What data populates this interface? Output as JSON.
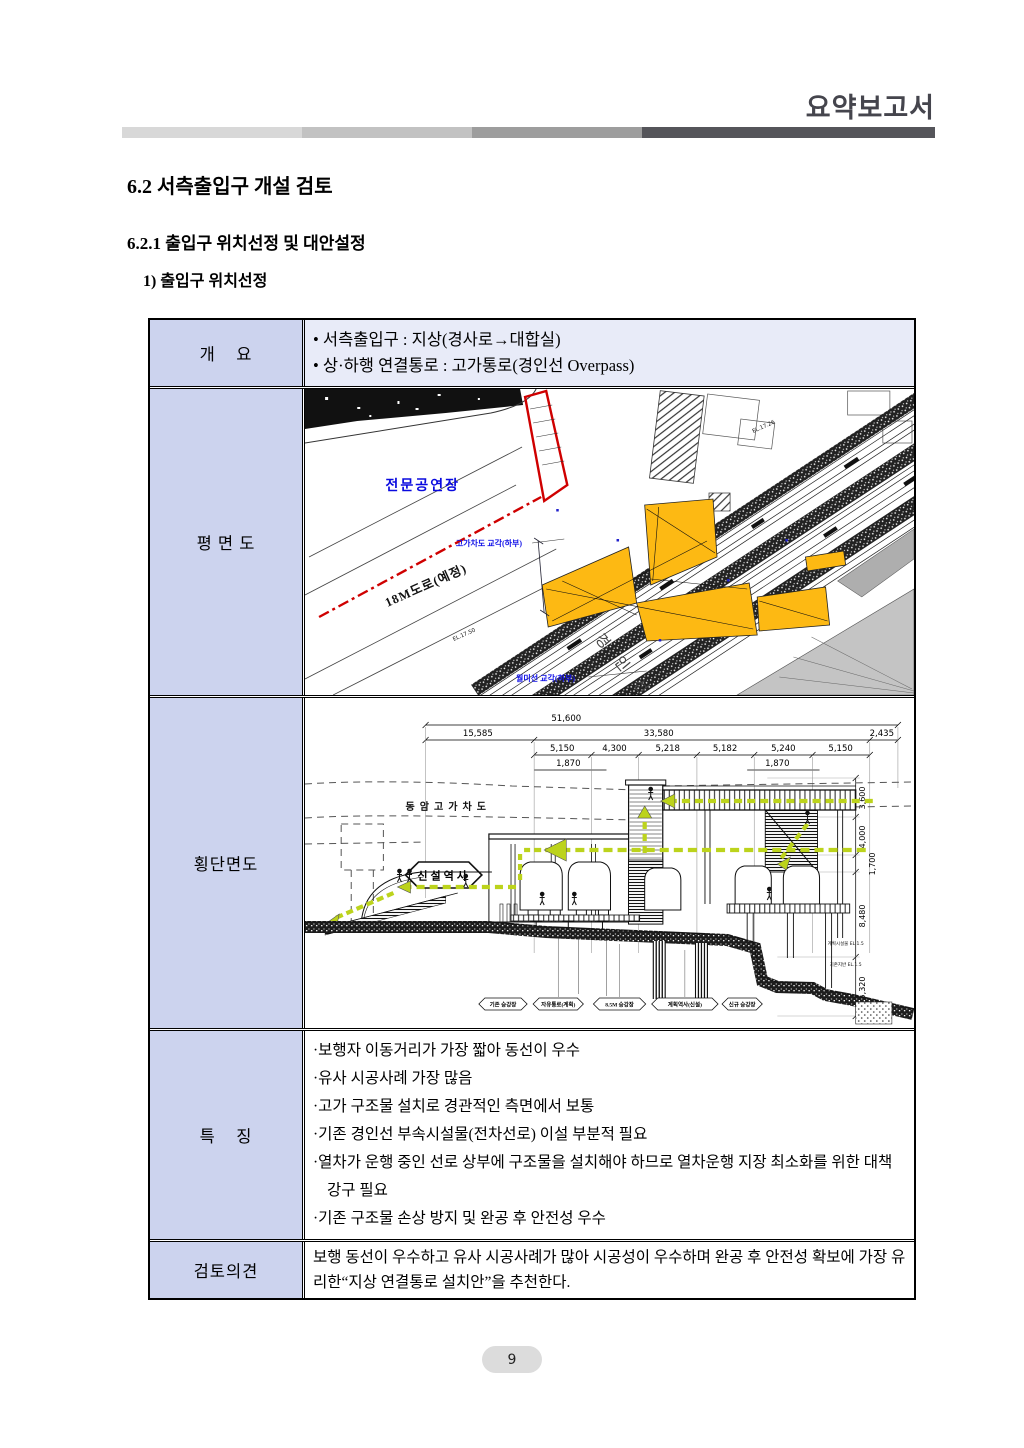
{
  "page": {
    "header_title": "요약보고서",
    "page_number": "9"
  },
  "headings": {
    "section": "6.2 서측출입구 개설 검토",
    "subsection": "6.2.1 출입구 위치선정 및 대안설정",
    "item": "1) 출입구 위치선정"
  },
  "table": {
    "row_labels": [
      "개    요",
      "평 면 도",
      "횡단면도",
      "특    징",
      "검토의견"
    ],
    "overview": [
      "서측출입구 : 지상(경사로→대합실)",
      "상·하행 연결통로 : 고가통로(경인선 Overpass)"
    ],
    "features": [
      "보행자 이동거리가 가장 짧아 동선이 우수",
      "유사 시공사례 가장 많음",
      "고가 구조물 설치로 경관적인 측면에서 보통",
      "기존 경인선 부속시설물(전차선로) 이설 부분적 필요",
      "열차가 운행 중인 선로 상부에 구조물을 설치해야 하므로 열차운행 지장 최소화를 위한 대책 강구 필요",
      "기존 구조물 손상 방지 및 완공 후 안전성 우수"
    ],
    "review": "보행 동선이 우수하고 유사 시공사례가 많아 시공성이 우수하며 완공 후 안전성 확보에 가장 유리한“지상 연결통로 설치안”을 추천한다."
  },
  "plan": {
    "hall_label": "전문공연장",
    "pier_label": "고가차도 교각(하부)",
    "rail_pier_label": "월미선 교각(하부)",
    "road_label": "18M도로(예정)",
    "railway_label": "경 인 선",
    "elev_marks": [
      "EL.17.26",
      "EL.17.50"
    ]
  },
  "section": {
    "dim_total": "51,600",
    "dims_level2": [
      "15,585",
      "33,580",
      "2,435"
    ],
    "dims_level3": [
      "5,150",
      "4,300",
      "5,218",
      "5,182",
      "5,240",
      "5,150"
    ],
    "dims_level4": [
      "1,870",
      "1,870"
    ],
    "dims_vertical": [
      "3,600",
      "4,000",
      "1,700",
      "8,480",
      "5,320"
    ],
    "overpass_label": "동암고가차도",
    "station_label": "신설역사",
    "hex_labels": [
      "기존 승강장",
      "자유통로(계획)",
      "8.5M 승강장",
      "계획역사(신설)",
      "신규 승강장"
    ],
    "notes": [
      "계획시설물 EL.1.5",
      "기존지반 EL.1.5"
    ]
  },
  "colors": {
    "label_cell_bg": "#ccd3ee",
    "overview_row_bg": "#e8ebf8",
    "highlight_yellow": "#fdb913",
    "boundary_red": "#cf0000",
    "annotation_blue": "#0a0adf",
    "flow_green": "#bcd31c",
    "header_bar": [
      "#d8d8d8",
      "#c2c2c2",
      "#9d9d9d",
      "#55555a"
    ]
  }
}
